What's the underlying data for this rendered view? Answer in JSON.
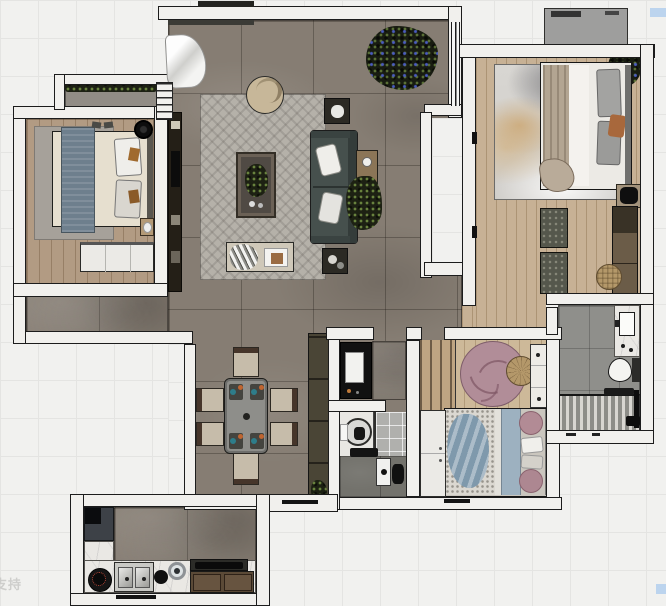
{
  "watermark": {
    "text": "支持"
  },
  "palette": {
    "canvas_bg": "#f1f1ef",
    "grid_line": "#e4e4e2",
    "wall_fill": "#f1f0ed",
    "wall_line": "#1c1c1c",
    "stone_floor": "#867d73",
    "wood_bedroom_left": "#b29b83",
    "wood_master": "#c7b195",
    "wood_bedroom_small": "#cdb999",
    "rug_living": "#b5b1a9",
    "rug_bedroom_left": "#a6a19a",
    "rug_pink": "#b18d98",
    "rug_pouf_tan": "#b4986a",
    "sofa_teal": "#46504d",
    "pillow_white": "#efeeea",
    "coffee_table": "#6b6156",
    "armchair_beige": "#c7b799",
    "media_unit_dark": "#241f17",
    "sideboard_olive": "#4a4536",
    "chair_beige": "#c6bcaa",
    "chair_back_brown": "#46352a",
    "accent_teal": "#2e7d8a",
    "accent_orange": "#bf6530",
    "bed_runner_blue": "#6e7f8d",
    "duvet_cream": "#e6dfcf",
    "blanket_taupe": "#b3a592",
    "pillow_gray": "#a3a3a1",
    "throw_blue": "#7f99ac",
    "band_blue": "#9db1c0",
    "pillow_pink": "#b28b95",
    "wardrobe_white": "#ebeae6",
    "cabinet_black": "#111111",
    "marble_counter": "#eae8e4",
    "tile_bath_main": "#8f8f8b",
    "tile_bath_small": "#b0b0ad",
    "floor_dark": "#73726c",
    "plant_dark": "#1d2113",
    "plant_blue_dots": "#4a5cc0",
    "ac_gray": "#9e9e9d",
    "steel_sink": "#c9c9c5",
    "watermark_gray": "#c8c8c6",
    "selection_blue": "#bcd4ee"
  },
  "scene": {
    "type": "apartment-floor-plan-render",
    "rooms": [
      "living-room",
      "dining-area",
      "bedroom-left",
      "balcony-left",
      "bedroom-master",
      "bathroom-main",
      "storage-room",
      "bathroom-small",
      "bedroom-small",
      "kitchen",
      "entry-landing",
      "hallway"
    ],
    "furniture": {
      "living_room": [
        "curtain",
        "area-rug-herringbone",
        "round-armchair",
        "sofa",
        "coffee-table",
        "side-table-top",
        "side-table-bottom",
        "console-table",
        "console-plant",
        "bench-with-throw",
        "large-plant",
        "media-wall-unit",
        "window"
      ],
      "bedroom_left": [
        "double-bed-blue-runner",
        "gray-rug",
        "nightstand",
        "ceiling-fan",
        "dresser-white",
        "slippers",
        "balcony-planter",
        "drying-rack"
      ],
      "bedroom_master": [
        "double-bed-white",
        "print-area-rug",
        "gray-pillows",
        "orange-pillow",
        "foot-drape",
        "nightstand",
        "bench-pair",
        "wardrobe",
        "woven-pouf",
        "corner-plant",
        "planter-row",
        "ac-unit"
      ],
      "bathroom_main": [
        "vanity-basin",
        "toilet",
        "shower-teak-mat",
        "shower-fixture",
        "bath-mat"
      ],
      "storage_room": [
        "black-cabinet"
      ],
      "bathroom_small": [
        "round-basin-mirror",
        "tile-wall",
        "bath-bar",
        "shower-panel",
        "shower-fixture"
      ],
      "bedroom_small": [
        "wardrobe-striped",
        "round-pink-rug",
        "round-pouf",
        "desk-white",
        "bed-blue-throw",
        "pink-round-pillows",
        "wardrobe-white"
      ],
      "dining_area": [
        "dining-table",
        "dining-chairs-x6",
        "place-settings",
        "sideboard",
        "sideboard-plant"
      ],
      "kitchen": [
        "fridge",
        "gas-burner",
        "double-sink",
        "kettle",
        "pot",
        "cooktop",
        "base-cabinets",
        "marble-counter-L"
      ]
    }
  }
}
